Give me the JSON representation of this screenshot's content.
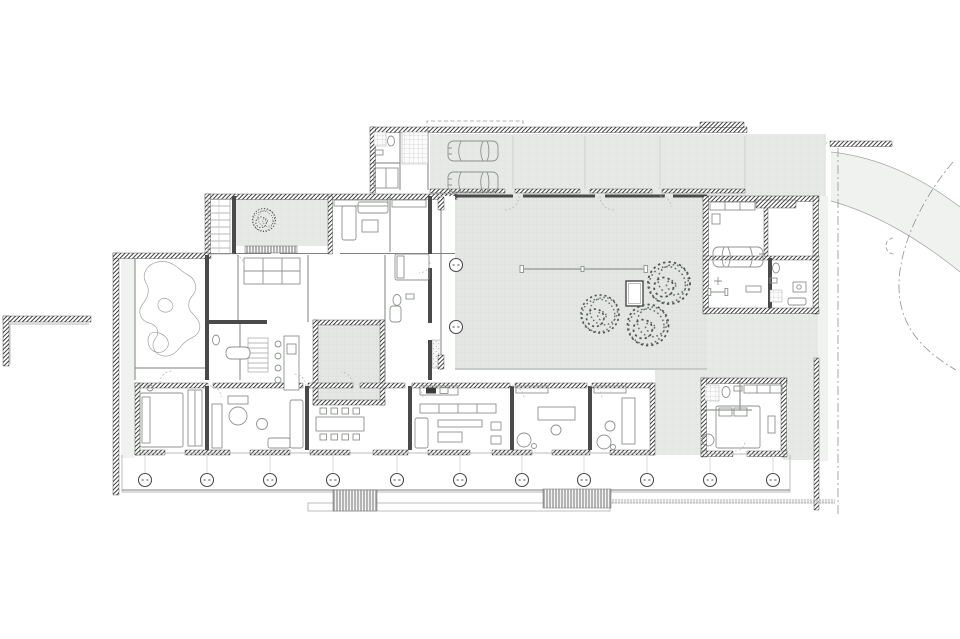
{
  "meta": {
    "title": "Ground floor plan of a courtyard house",
    "drawing_type": "architectural floor plan",
    "visible_text": []
  },
  "colors": {
    "paper": "#ffffff",
    "wall-dark": "#2a2a2a",
    "line": "#7d827d",
    "furniture": "#8d938d",
    "paving": "#e7e9e7",
    "courtyard": "#e3e6e3",
    "road": "#f0f2f0",
    "grid": "#d6dad6"
  },
  "inventory": {
    "cars": 3,
    "trees": 4,
    "veranda_columns": 11,
    "courtyard_columns": 2,
    "exterior_stairs": 2,
    "interior_stairs": 2,
    "courtyards": 3,
    "garages": 2
  }
}
